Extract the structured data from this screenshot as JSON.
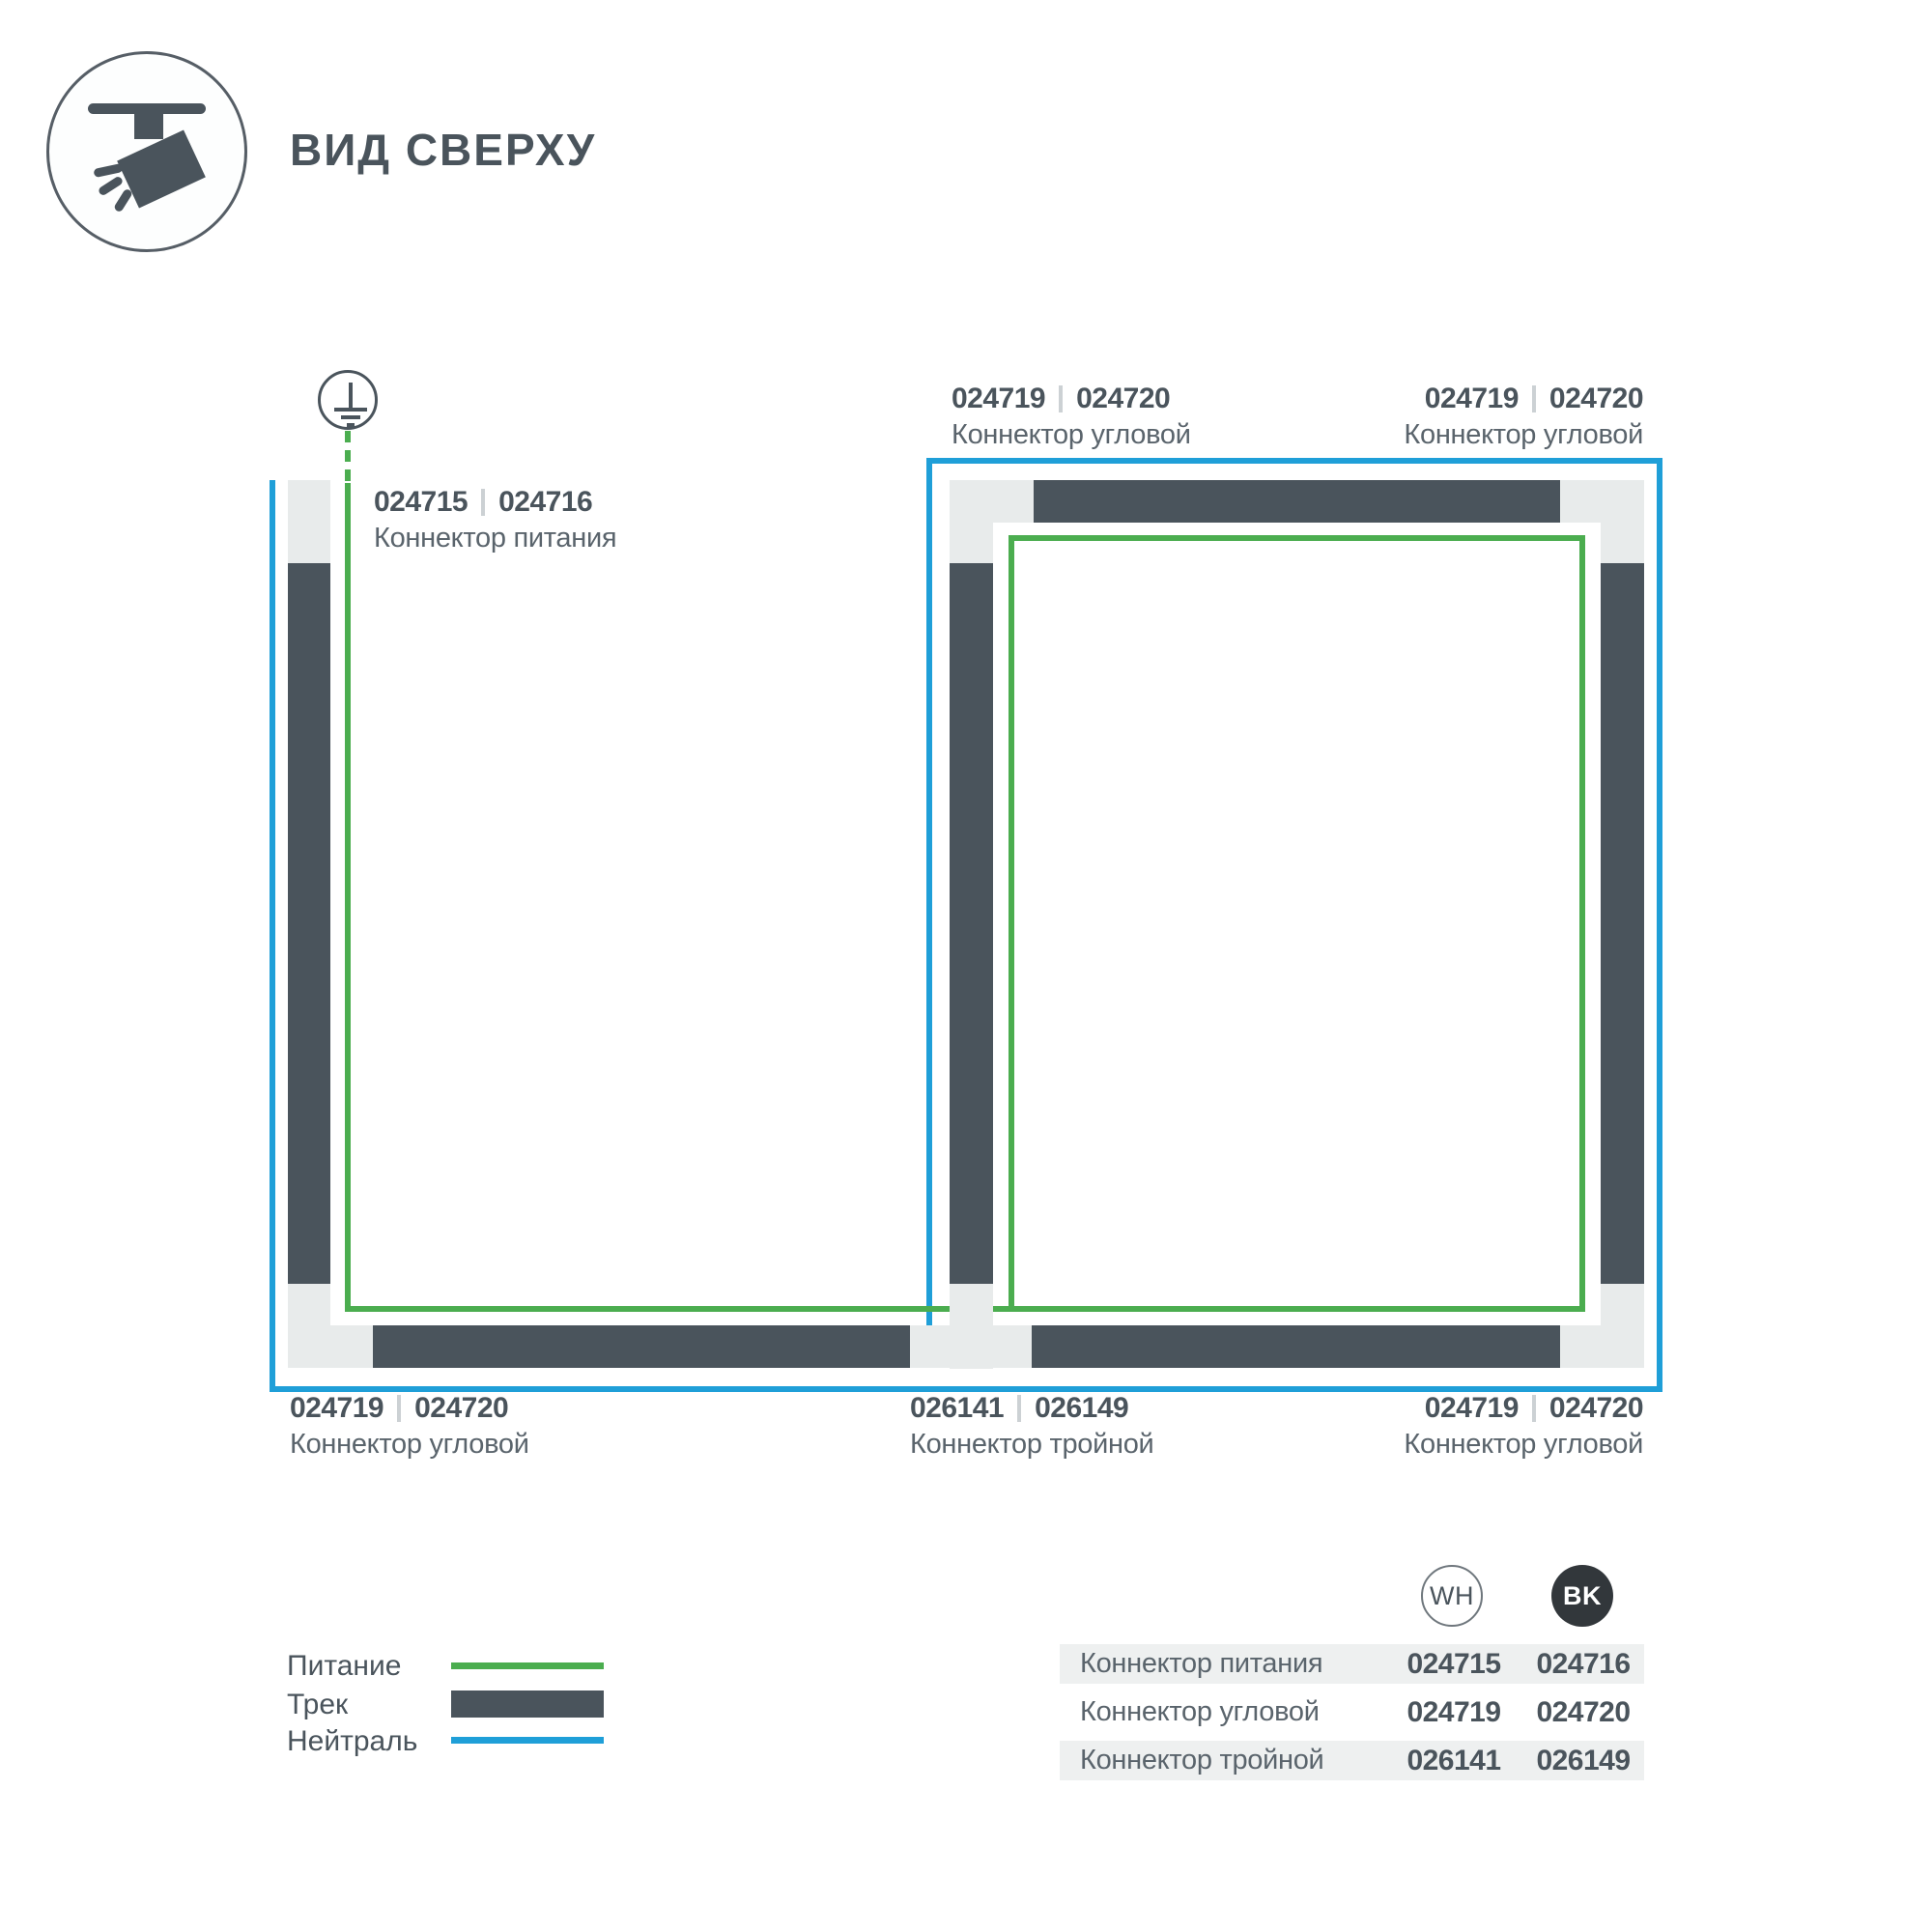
{
  "header": {
    "title": "ВИД СВЕРХУ",
    "icon": "track-spotlight-icon"
  },
  "colors": {
    "power_green": "#4bad4f",
    "neutral_blue": "#1f9fd8",
    "track_dark": "#4a545c",
    "connector_gray": "#e8ebeb",
    "table_row_bg": "#eef0f0",
    "text_primary": "#4a545c",
    "text_secondary": "#5a646c",
    "code_separator": "#ccd1d4",
    "bk_badge_fill": "#32373b"
  },
  "diagram": {
    "ground_icon": "protective-earth-icon",
    "labels": {
      "top_left": {
        "wh": "024719",
        "bk": "024720",
        "name": "Коннектор угловой"
      },
      "top_right": {
        "wh": "024719",
        "bk": "024720",
        "name": "Коннектор угловой"
      },
      "power": {
        "wh": "024715",
        "bk": "024716",
        "name": "Коннектор питания"
      },
      "bottom_left": {
        "wh": "024719",
        "bk": "024720",
        "name": "Коннектор угловой"
      },
      "bottom_middle": {
        "wh": "026141",
        "bk": "026149",
        "name": "Коннектор тройной"
      },
      "bottom_right": {
        "wh": "024719",
        "bk": "024720",
        "name": "Коннектор угловой"
      }
    }
  },
  "legend": {
    "power": "Питание",
    "track": "Трек",
    "neutral": "Нейтраль"
  },
  "table": {
    "col_wh": "WH",
    "col_bk": "BK",
    "rows": [
      {
        "name": "Коннектор питания",
        "wh": "024715",
        "bk": "024716"
      },
      {
        "name": "Коннектор угловой",
        "wh": "024719",
        "bk": "024720"
      },
      {
        "name": "Коннектор тройной",
        "wh": "026141",
        "bk": "026149"
      }
    ]
  }
}
